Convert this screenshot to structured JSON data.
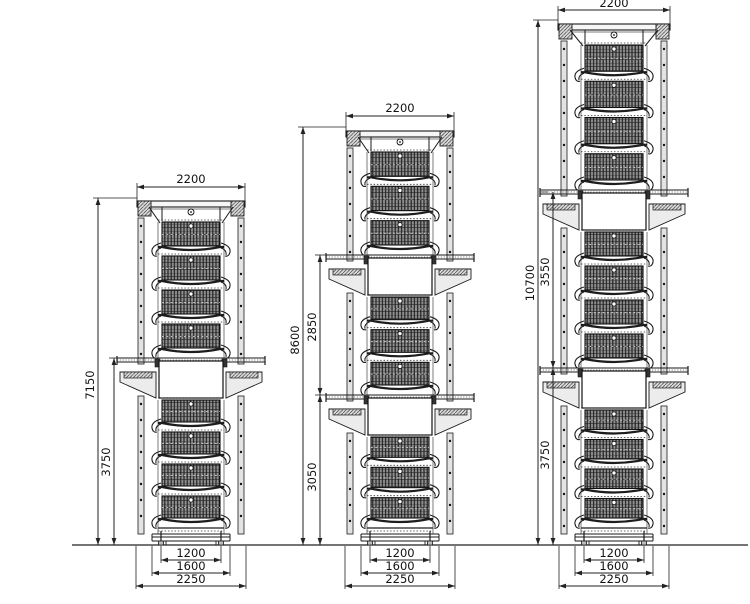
{
  "page": {
    "background": "#ffffff"
  },
  "colors": {
    "line": "#1a1a1a",
    "dim_line": "#222222",
    "text": "#111111",
    "mesh_bg": "#8f8f8f",
    "mesh_grid": "#1c1c1c",
    "column_fill": "#e3e3e3",
    "plate_fill": "#f6f6f6",
    "box_fill": "#ffffff",
    "hopper_fill": "#ececec"
  },
  "diagram": {
    "ground": {
      "y": 545,
      "x1": 72,
      "x2": 748
    },
    "towers": [
      {
        "name": "tower-left-two-unit-4-tier",
        "cx": 191,
        "plate_half": 54,
        "base_top": 528,
        "stacks": [
          {
            "tiers": 4,
            "seg_top": 197,
            "seg_end": 358
          },
          {
            "tiers": 4,
            "seg_top": 358,
            "seg_end": 528
          }
        ],
        "top_dim": {
          "label": "2200",
          "y": 187,
          "half": 54,
          "text_y": 183
        },
        "vertical_dims": [
          {
            "label": "7150",
            "x": 98,
            "y1": 198,
            "y2": 545,
            "ext_to": 137,
            "label_cx": 90,
            "label_cy": 385
          },
          {
            "label": "3750",
            "x": 114,
            "y1": 358,
            "y2": 545,
            "ext_to": 118,
            "label_cx": 106,
            "label_cy": 462
          }
        ],
        "bottom_dims": [
          {
            "label": "1200",
            "half": 30,
            "y": 560
          },
          {
            "label": "1600",
            "half": 39,
            "y": 573
          },
          {
            "label": "2250",
            "half": 55,
            "y": 586
          }
        ]
      },
      {
        "name": "tower-middle-three-unit-3-tier",
        "cx": 400,
        "plate_half": 54,
        "base_top": 528,
        "stacks": [
          {
            "tiers": 3,
            "seg_top": 127,
            "seg_end": 255
          },
          {
            "tiers": 3,
            "seg_top": 255,
            "seg_end": 395
          },
          {
            "tiers": 3,
            "seg_top": 395,
            "seg_end": 528
          }
        ],
        "top_dim": {
          "label": "2200",
          "y": 116,
          "half": 54,
          "text_y": 112
        },
        "vertical_dims": [
          {
            "label": "8600",
            "x": 303,
            "y1": 127,
            "y2": 545,
            "ext_to": 346,
            "label_cx": 295,
            "label_cy": 340
          },
          {
            "label": "2850",
            "x": 320,
            "y1": 255,
            "y2": 395,
            "ext_to": 327,
            "label_cx": 312,
            "label_cy": 327
          },
          {
            "label": "3050",
            "x": 320,
            "y1": 395,
            "y2": 545,
            "ext_to": 327,
            "label_cx": 312,
            "label_cy": 477
          }
        ],
        "bottom_dims": [
          {
            "label": "1200",
            "half": 30,
            "y": 560
          },
          {
            "label": "1600",
            "half": 39,
            "y": 573
          },
          {
            "label": "2250",
            "half": 55,
            "y": 586
          }
        ]
      },
      {
        "name": "tower-right-three-unit-4-tier",
        "cx": 614,
        "plate_half": 56,
        "base_top": 528,
        "stacks": [
          {
            "tiers": 4,
            "seg_top": 20,
            "seg_end": 190
          },
          {
            "tiers": 4,
            "seg_top": 190,
            "seg_end": 368
          },
          {
            "tiers": 4,
            "seg_top": 368,
            "seg_end": 528
          }
        ],
        "top_dim": {
          "label": "2200",
          "y": 10,
          "half": 56,
          "text_y": 7
        },
        "vertical_dims": [
          {
            "label": "10700",
            "x": 538,
            "y1": 20,
            "y2": 545,
            "ext_to": 558,
            "label_cx": 530,
            "label_cy": 283
          },
          {
            "label": "3550",
            "x": 553,
            "y1": 192,
            "y2": 368,
            "ext_to": 541,
            "label_cx": 545,
            "label_cy": 272
          },
          {
            "label": "3750",
            "x": 553,
            "y1": 368,
            "y2": 545,
            "ext_to": 541,
            "label_cx": 545,
            "label_cy": 455
          }
        ],
        "bottom_dims": [
          {
            "label": "1200",
            "half": 30,
            "y": 560
          },
          {
            "label": "1600",
            "half": 39,
            "y": 573
          },
          {
            "label": "2250",
            "half": 55,
            "y": 586
          }
        ]
      }
    ]
  }
}
